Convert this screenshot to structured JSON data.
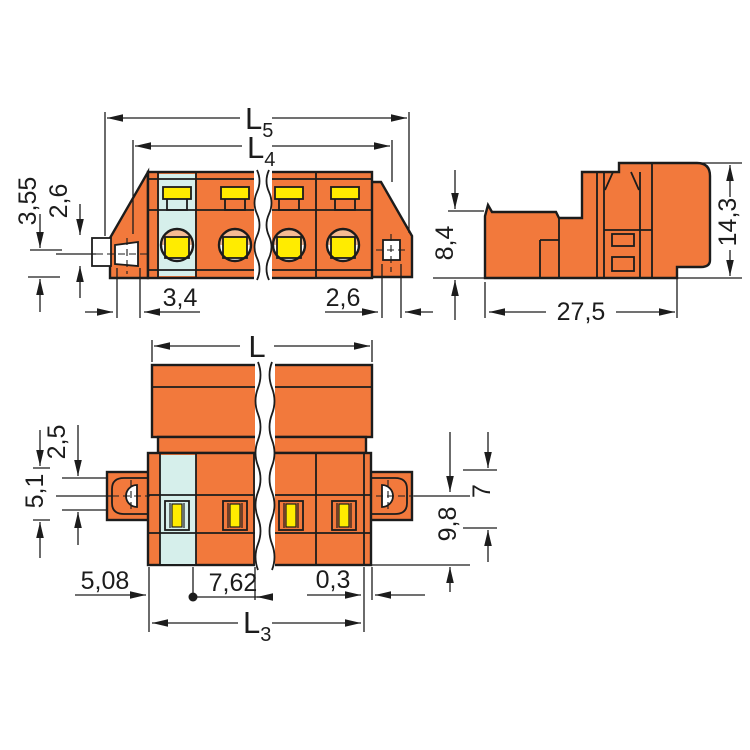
{
  "colors": {
    "body_orange": "#f2793c",
    "first_pole_cyan": "#d6efeb",
    "screw_yellow": "#ffec00",
    "contact_salmon": "#f6bb92",
    "line": "#1c1c1c",
    "background": "#ffffff"
  },
  "views": {
    "front": {
      "dim_l5": {
        "main": "L",
        "sub": "5"
      },
      "dim_l4": {
        "main": "L",
        "sub": "4"
      },
      "dim_height_a": "3,55",
      "dim_height_b": "2,6",
      "dim_hole_left": "3,4",
      "dim_hole_right": "2,6"
    },
    "side": {
      "dim_front_height": "8,4",
      "dim_total_height": "14,3",
      "dim_depth": "27,5"
    },
    "plan": {
      "dim_l": "L",
      "dim_flange_height": "5,1",
      "dim_tab_height": "2,5",
      "dim_right_a": "7",
      "dim_right_b": "9,8",
      "dim_edge_offset": "5,08",
      "dim_pitch": "7,62",
      "dim_gap": "0,3",
      "dim_l3": {
        "main": "L",
        "sub": "3"
      }
    }
  }
}
